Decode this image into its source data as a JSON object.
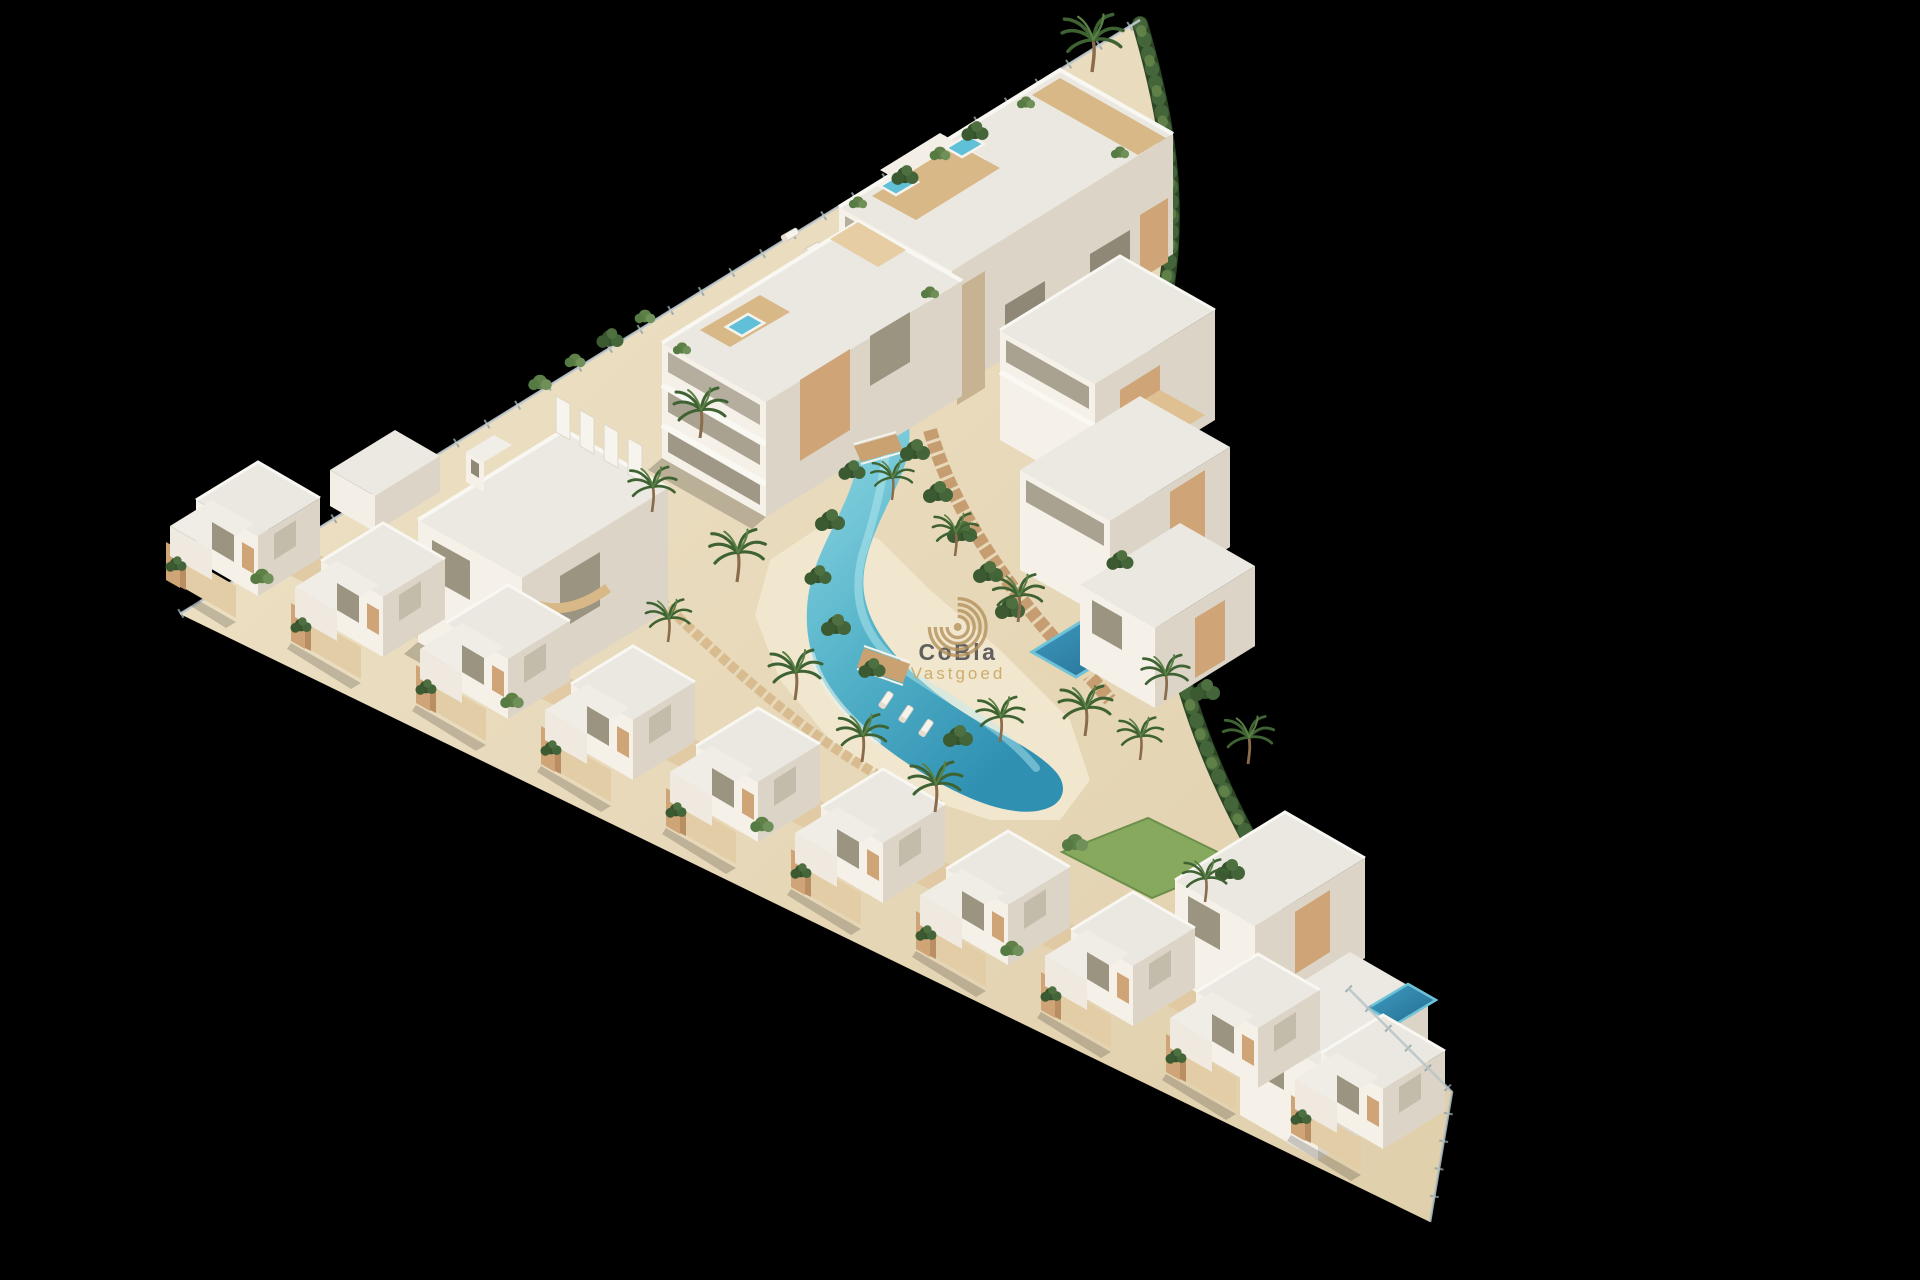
{
  "image": {
    "description": "Aerial 3D render of a Mediterranean-style residential development: white apartment blocks and a diagonal row of townhouse villas around a winding turquoise lagoon pool with palm gardens, on a black background",
    "background_color": "#000000"
  },
  "watermark": {
    "brand": "CoBla",
    "subtitle": "Vastgoed",
    "brand_color": "#4c4d52",
    "subtitle_color": "#c6a25a",
    "logo_icon": "concentric-arcs-logo-icon",
    "logo_color": "#b3905a"
  },
  "palette": {
    "building_white": "#f5f1e9",
    "building_shadow_face": "#dcd5c7",
    "roof": "#ebe8e1",
    "wood_accent": "#cfa477",
    "stone": "#c7b292",
    "sand_ground": "#e9dcc1",
    "paving": "#c49a6c",
    "lagoon_pool_light": "#9adfe8",
    "lagoon_pool_deep": "#2f90b2",
    "private_pool": "#2f86ac",
    "jacuzzi_blue": "#5fc0d8",
    "hedge_green": "#2c4524",
    "foliage_green": "#44653a",
    "palm_green": "#3f6233",
    "lawn_green": "#87a95e"
  },
  "scene": {
    "features": [
      "apartment-building-upper",
      "apartment-building-lower",
      "arched-house",
      "terrace-building",
      "pool-villa-east",
      "bottom-right-villas",
      "townhouse-villa-row",
      "lagoon-pool",
      "pool-bridges",
      "wooden-walkways",
      "beach-area",
      "palm-trees",
      "perimeter-hedge",
      "glass-fence",
      "rooftop-jacuzzis",
      "sun-loungers",
      "lawn-patch"
    ],
    "townhouse_villa_count": 10
  }
}
